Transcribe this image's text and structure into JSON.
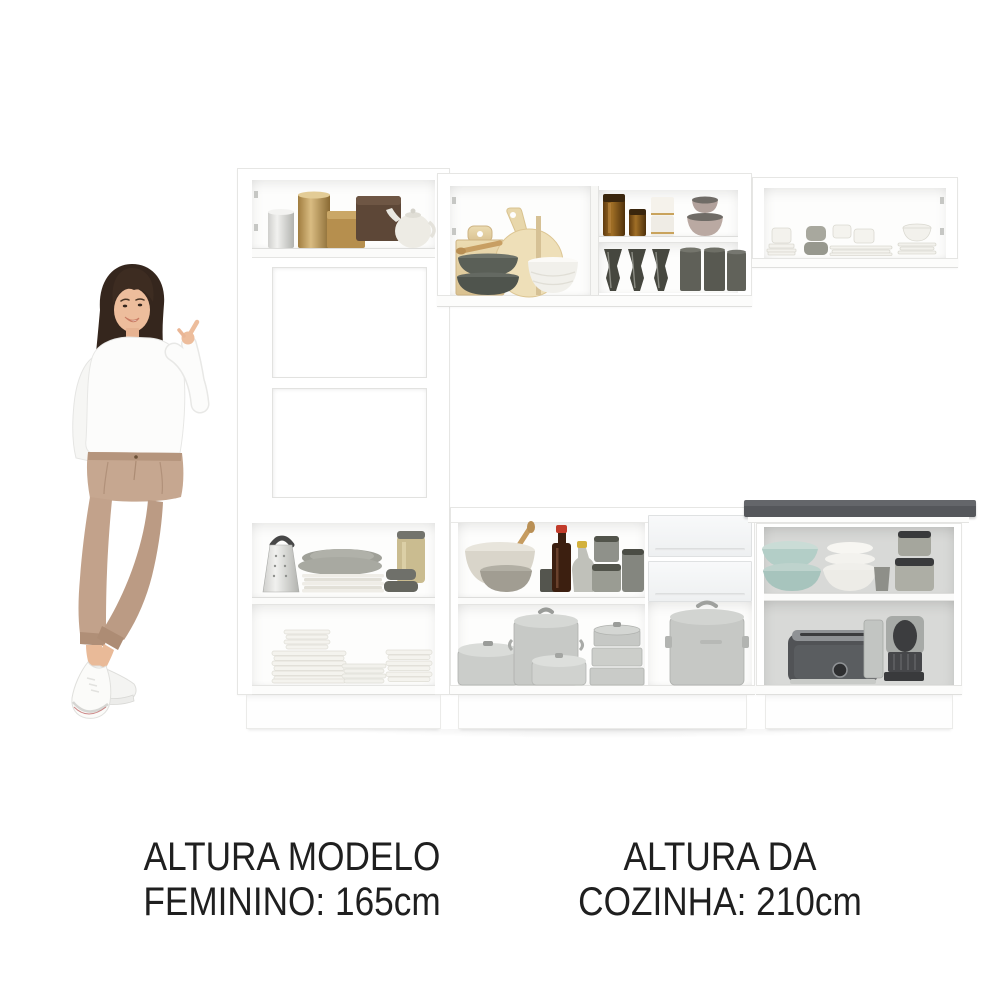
{
  "image_alt": "White modular kitchen cabinet set with open shelves full of kitchenware; a woman points at the furniture as a height reference",
  "captions": {
    "model": {
      "line1": "ALTURA MODELO",
      "line2": "FEMININO: 165cm"
    },
    "kitchen": {
      "line1": "ALTURA DA",
      "line2": "COZINHA: 210cm"
    }
  },
  "measurements": {
    "model_height_cm": "165",
    "kitchen_height_cm": "210"
  },
  "colors": {
    "text": "#1f1f1f",
    "cabinet_white": "#ffffff",
    "cabinet_edge": "#e6e6e4",
    "countertop_dark": "#515358",
    "interior_gray_back": "#d8d9d7",
    "wood_board": "#e8d8ae",
    "aluminium": "#cbcdca",
    "amber_glass": "#8a5a20",
    "teal_bowl": "#b3cec7",
    "pants_tan": "#c2a28b",
    "hair_brown": "#35261d"
  },
  "scene": {
    "figure": "woman-pointing-up",
    "sections": [
      {
        "name": "tall-cabinet-left",
        "items": [
          "silver-canister",
          "gold-canister",
          "gold-tin",
          "brown-box",
          "white-teapot",
          "open-niche-1",
          "open-niche-2",
          "box-grater",
          "gray-platter-stack",
          "storage-jar",
          "small-dark-bowls",
          "white-plate-stacks"
        ]
      },
      {
        "name": "wall-cabinet-middle",
        "items": [
          "rectangular-cutting-board",
          "round-cutting-board",
          "wooden-spoon",
          "dark-bowl-stack",
          "white-bowl",
          "amber-jars",
          "white-canisters",
          "beige-lidded-bowls",
          "smoked-goblets",
          "smoked-tumblers"
        ]
      },
      {
        "name": "wall-cabinet-right",
        "items": [
          "white-cup-stacks",
          "gray-cup-stack",
          "saucer-stacks",
          "white-bowl-stack"
        ]
      },
      {
        "name": "base-cabinet-middle",
        "items": [
          "mixing-bowl-with-spoon",
          "gray-bowl-stack",
          "dark-bottle-red-cap",
          "oil-cruet",
          "dark-cup",
          "gray-canisters",
          "saucepan",
          "stockpot",
          "casserole",
          "steamer-stack",
          "drawer-1",
          "drawer-2",
          "large-lidded-pot"
        ]
      },
      {
        "name": "base-cabinet-right",
        "items": [
          "dark-countertop",
          "teal-bowls",
          "white-bowl-stack",
          "gray-tumbler",
          "lidded-canisters",
          "toaster",
          "espresso-machine"
        ]
      }
    ]
  }
}
